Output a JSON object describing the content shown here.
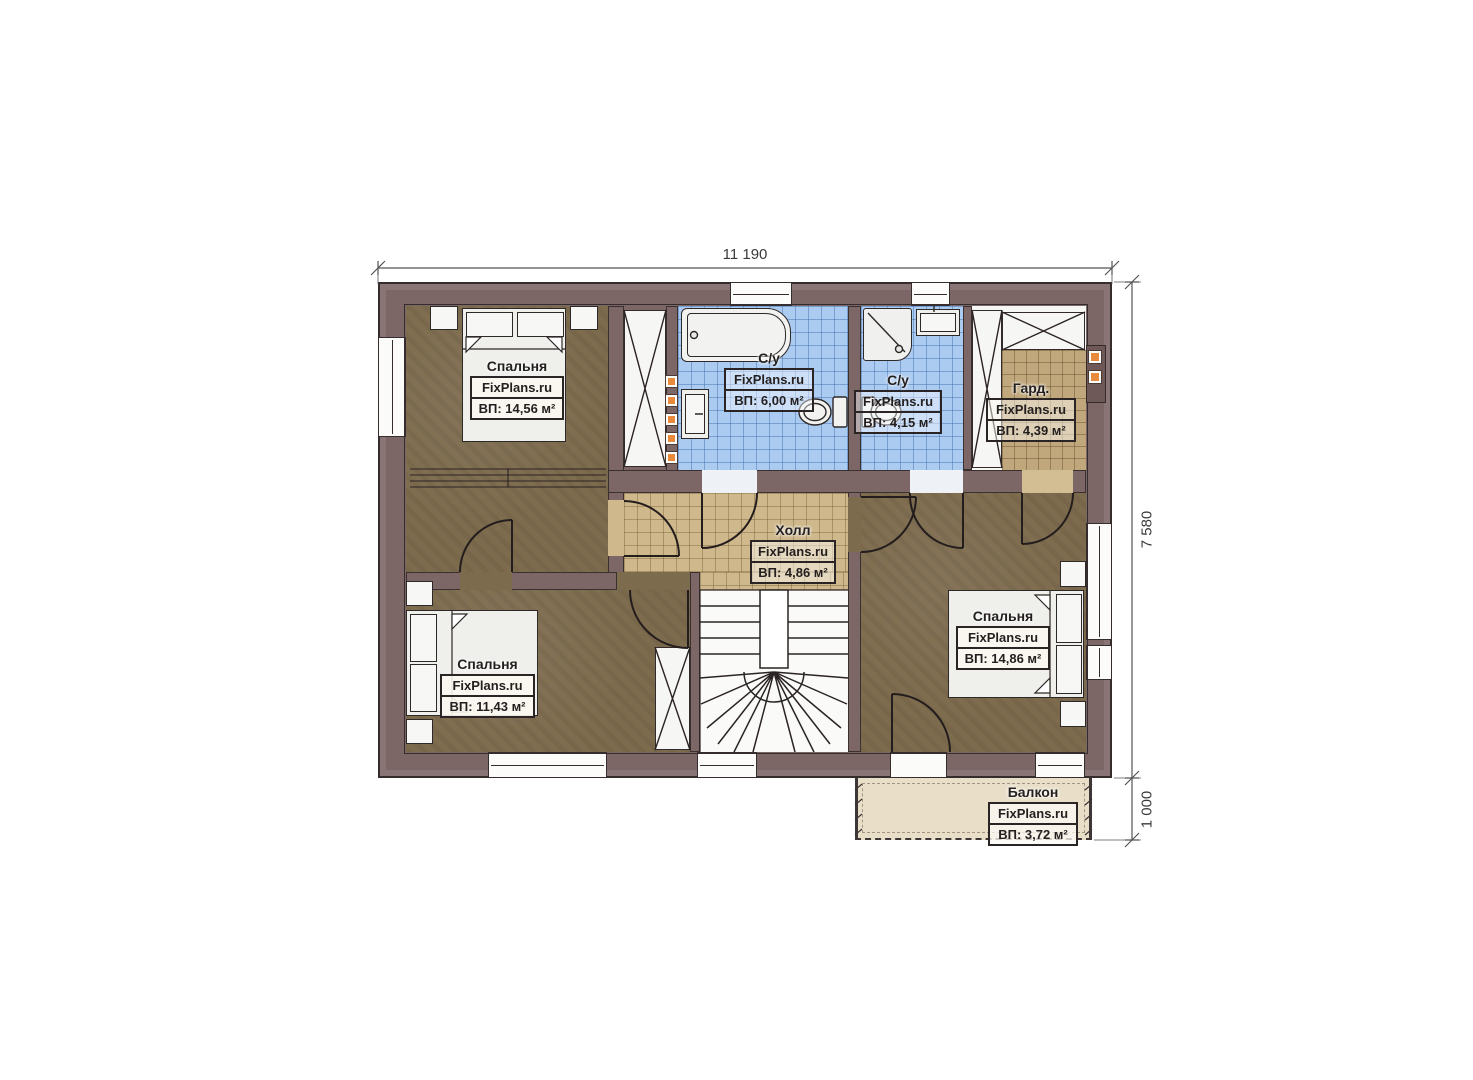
{
  "brand": "FixPlans.ru",
  "dimensions": {
    "top_width": "11 190",
    "right_height": "7 580",
    "balcony_depth": "1 000"
  },
  "rooms": {
    "bedroom_top_left": {
      "name": "Спальня",
      "brand": "FixPlans.ru",
      "area": "ВП: 14,56 м²"
    },
    "bathroom_main": {
      "name": "С/у",
      "brand": "FixPlans.ru",
      "area": "ВП: 6,00 м²"
    },
    "bathroom_second": {
      "name": "С/у",
      "brand": "FixPlans.ru",
      "area": "ВП: 4,15 м²"
    },
    "wardrobe": {
      "name": "Гард.",
      "brand": "FixPlans.ru",
      "area": "ВП: 4,39 м²"
    },
    "hall": {
      "name": "Холл",
      "brand": "FixPlans.ru",
      "area": "ВП: 4,86 м²"
    },
    "bedroom_bottom_left": {
      "name": "Спальня",
      "brand": "FixPlans.ru",
      "area": "ВП: 11,43 м²"
    },
    "bedroom_bottom_right": {
      "name": "Спальня",
      "brand": "FixPlans.ru",
      "area": "ВП: 14,86 м²"
    },
    "balcony": {
      "name": "Балкон",
      "brand": "FixPlans.ru",
      "area": "ВП: 3,72 м²"
    }
  },
  "colors": {
    "wall": "#7c6666",
    "bedroom_floor": "#7d6b4d",
    "bathroom_tile": "#abcbf0",
    "hall_tile": "#cfb88c",
    "wardrobe_tile": "#c1a87c",
    "balcony_floor": "#e9dfc9",
    "radiator_accent": "#e98a3c",
    "line": "#2b2323"
  }
}
